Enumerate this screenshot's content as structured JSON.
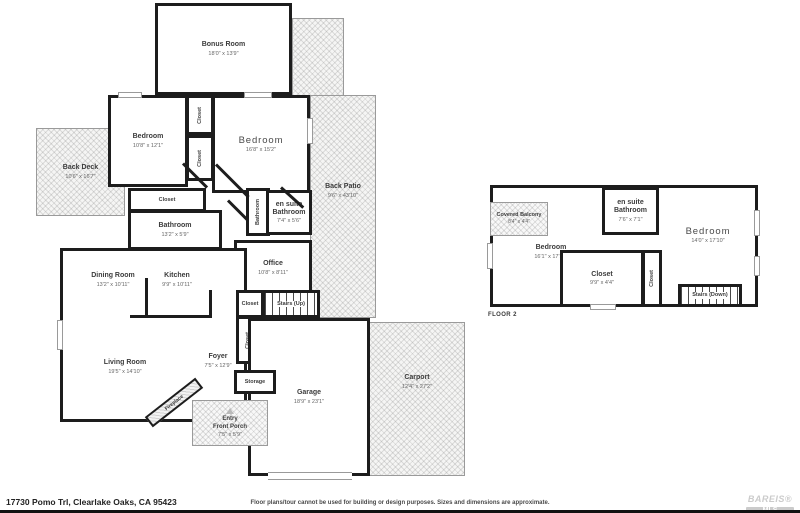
{
  "meta": {
    "address": "17730 Pomo Trl, Clearlake Oaks, CA 95423",
    "disclaimer": "Floor plans/tour cannot be used for building or design purposes. Sizes and dimensions are approximate.",
    "brand": {
      "line1": "BAREIS®",
      "line2": "MLS"
    },
    "colors": {
      "wall": "#1d1d1d",
      "hatch": "#e9e9e9",
      "text": "#3c3c3c"
    }
  },
  "floor1": {
    "bonus_room": {
      "name": "Bonus Room",
      "dims": "18'0\" x 13'9\""
    },
    "bedroom_small": {
      "name": "Bedroom",
      "dims": "10'8\" x 12'1\""
    },
    "bedroom_large": {
      "name": "Bedroom",
      "dims": "16'8\" x 15'2\""
    },
    "closet_1": {
      "name": "Closet"
    },
    "closet_2": {
      "name": "Closet"
    },
    "back_deck": {
      "name": "Back Deck",
      "dims": "10'6\" x 16'7\""
    },
    "closet_hall": {
      "name": "Closet"
    },
    "bathroom": {
      "name": "Bathroom",
      "dims": "13'2\" x 5'9\""
    },
    "bathroom_vert": {
      "name": "Bathroom"
    },
    "ensuite_bathroom": {
      "name": "en suite Bathroom",
      "dims": "7'4\" x 5'6\""
    },
    "back_patio": {
      "name": "Back Patio",
      "dims": "9'6\" x 43'10\""
    },
    "office": {
      "name": "Office",
      "dims": "10'8\" x 8'11\""
    },
    "dining_room": {
      "name": "Dining Room",
      "dims": "13'2\" x 10'11\""
    },
    "kitchen": {
      "name": "Kitchen",
      "dims": "9'9\" x 10'11\""
    },
    "closet_stairs": {
      "name": "Closet"
    },
    "stairs_up": {
      "name": "Stairs (Up)"
    },
    "closet_foyer": {
      "name": "Closet"
    },
    "living_room": {
      "name": "Living Room",
      "dims": "19'5\" x 14'10\""
    },
    "foyer": {
      "name": "Foyer",
      "dims": "7'5\" x 12'9\""
    },
    "storage": {
      "name": "Storage"
    },
    "garage": {
      "name": "Garage",
      "dims": "18'9\" x 23'1\""
    },
    "carport": {
      "name": "Carport",
      "dims": "12'4\" x 27'2\""
    },
    "fireplace": {
      "name": "Fireplace"
    },
    "entry": {
      "line1": "Entry",
      "line2": "Front Porch",
      "dims": "7'5\" x 5'9\""
    }
  },
  "floor2": {
    "label": "FLOOR 2",
    "covered_balcony": {
      "name": "Covered Balcony",
      "dims": "8'4\" x 4'4\""
    },
    "bedroom_left": {
      "name": "Bedroom",
      "dims": "16'1\" x 17'10\""
    },
    "ensuite_bathroom": {
      "name": "en suite Bathroom",
      "dims": "7'6\" x 7'1\""
    },
    "bedroom_right": {
      "name": "Bedroom",
      "dims": "14'0\" x 17'10\""
    },
    "closet": {
      "name": "Closet",
      "dims": "9'9\" x 4'4\""
    },
    "closet_vert": {
      "name": "Closet"
    },
    "stairs_down": {
      "name": "Stairs (Down)"
    }
  }
}
